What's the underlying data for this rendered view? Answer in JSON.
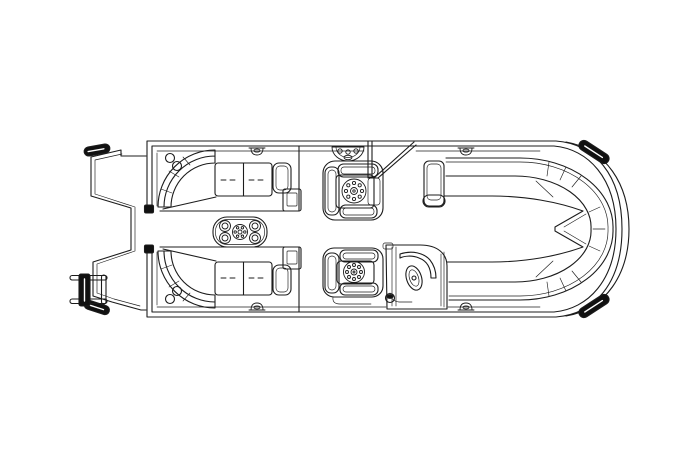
{
  "diagram": {
    "type": "pontoon-boat-deck-plan-top-view",
    "background_color": "#ffffff",
    "line_color": "#1c1c1c",
    "accent_black": "#111111",
    "components": {
      "bow": [
        "bow-platform",
        "boarding-ladder",
        "bow-corner-cap",
        "bow-tip-cap",
        "bow-gate"
      ],
      "midship": [
        "port-bow-lounge",
        "starboard-bow-lounge",
        "cocktail-table",
        "cup-holders",
        "co-captain-chair",
        "entry-gate",
        "gate-step-pad",
        "helm-chair",
        "helm-console",
        "steering-wheel"
      ],
      "stern": [
        "starboard-aft-bench",
        "port-aft-bench",
        "stern-wraparound-seat",
        "stern-notch",
        "stern-corner-caps",
        "mooring-cleats"
      ]
    }
  }
}
